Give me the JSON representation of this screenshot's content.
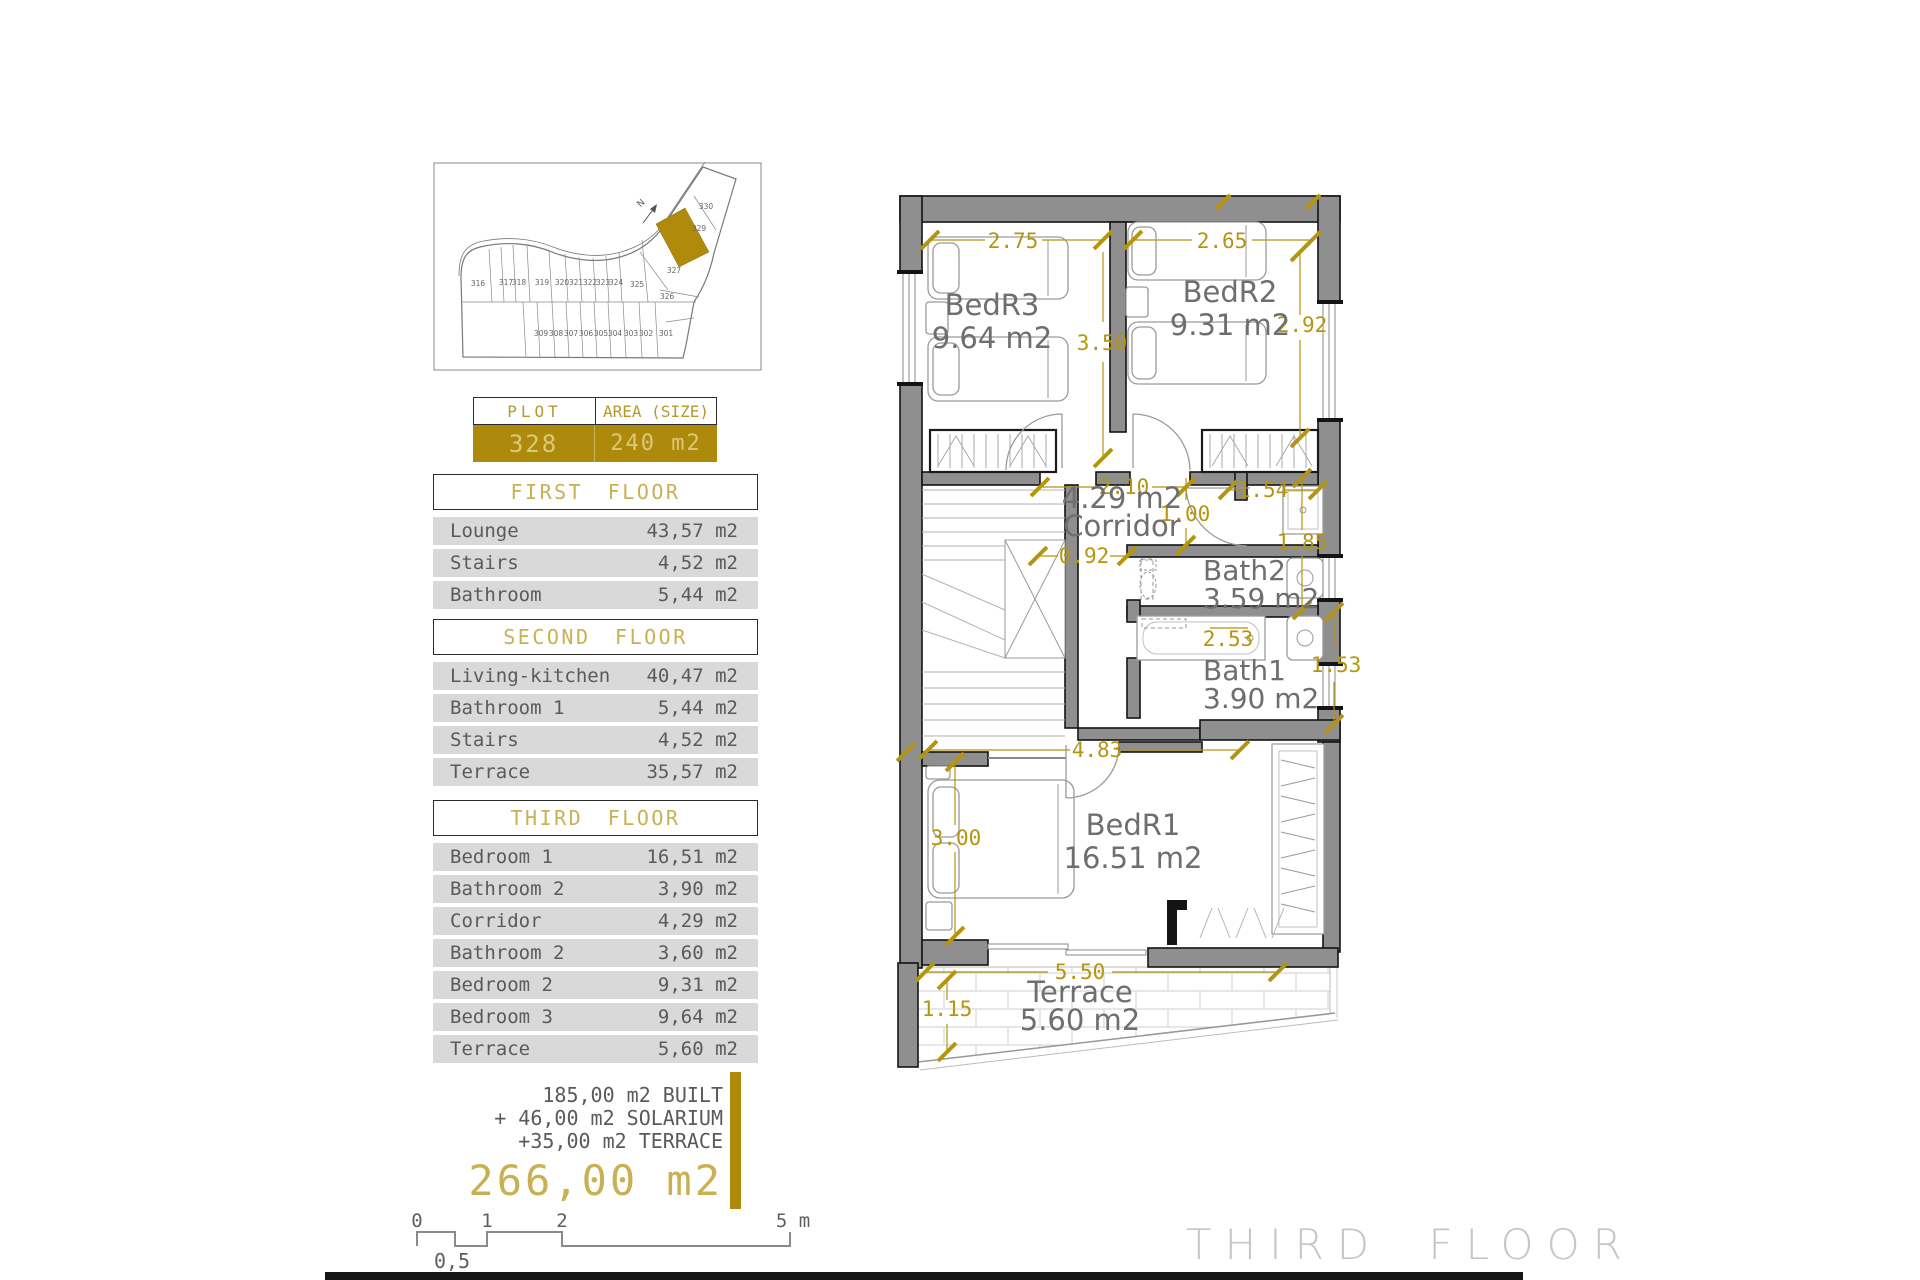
{
  "colors": {
    "gold": "#AD890C",
    "khaki": "#C9B052",
    "pale_gold": "#DCC878",
    "row_bg": "#D9D9D9",
    "text_gray": "#5A5A5A",
    "wall_gray": "#8F8F8F",
    "label_gray": "#6E6E6E",
    "dim_gold": "#B5950F",
    "caption_gray": "#C6C6C6"
  },
  "site_plan": {
    "north": "N",
    "top_row": [
      "316",
      "317",
      "318",
      "319",
      "320",
      "321",
      "322",
      "323",
      "324",
      "325"
    ],
    "bottom_row": [
      "309",
      "308",
      "307",
      "306",
      "305",
      "304",
      "303",
      "302",
      "301"
    ],
    "wing": [
      "330",
      "329",
      "327",
      "326"
    ],
    "highlighted_plot": "328"
  },
  "plot_table": {
    "col1_header": "PLOT",
    "col2_header": "AREA (SIZE)",
    "plot": "328",
    "area": "240 m2"
  },
  "floors": [
    {
      "title": "FIRST FLOOR",
      "rows": [
        {
          "label": "Lounge",
          "value": "43,57 m2"
        },
        {
          "label": "Stairs",
          "value": "4,52 m2"
        },
        {
          "label": "Bathroom",
          "value": "5,44 m2"
        }
      ]
    },
    {
      "title": "SECOND FLOOR",
      "rows": [
        {
          "label": "Living-kitchen",
          "value": "40,47 m2"
        },
        {
          "label": "Bathroom 1",
          "value": "5,44 m2"
        },
        {
          "label": "Stairs",
          "value": "4,52 m2"
        },
        {
          "label": "Terrace",
          "value": "35,57 m2"
        }
      ]
    },
    {
      "title": "THIRD FLOOR",
      "rows": [
        {
          "label": "Bedroom 1",
          "value": "16,51 m2"
        },
        {
          "label": "Bathroom 2",
          "value": "3,90 m2"
        },
        {
          "label": "Corridor",
          "value": "4,29 m2"
        },
        {
          "label": "Bathroom 2",
          "value": "3,60 m2"
        },
        {
          "label": "Bedroom 2",
          "value": "9,31 m2"
        },
        {
          "label": "Bedroom 3",
          "value": "9,64 m2"
        },
        {
          "label": "Terrace",
          "value": "5,60 m2"
        }
      ]
    }
  ],
  "summary": {
    "line1": "185,00 m2 BUILT",
    "line2": "+ 46,00 m2 SOLARIUM",
    "line3": "+35,00 m2 TERRACE",
    "total": "266,00 m2"
  },
  "scale_bar": {
    "ticks": [
      "0",
      "1",
      "2"
    ],
    "end": "5 m",
    "half": "0,5"
  },
  "floor_plan": {
    "caption": "THIRD FLOOR",
    "rooms": [
      {
        "name": "BedR3",
        "area": "9.64 m2"
      },
      {
        "name": "BedR2",
        "area": "9.31 m2"
      },
      {
        "name": "Corridor",
        "area": "4.29 m2"
      },
      {
        "name": "Bath2",
        "area": "3.59 m2"
      },
      {
        "name": "Bath1",
        "area": "3.90 m2"
      },
      {
        "name": "BedR1",
        "area": "16.51 m2"
      },
      {
        "name": "Terrace",
        "area": "5.60 m2"
      }
    ],
    "dims": [
      "2.75",
      "2.65",
      "3.50",
      "2.92",
      "2.10",
      "1.00",
      "1.54",
      "0.92",
      "1.85",
      "2.53",
      "1.53",
      "4.83",
      "3.00",
      "5.50",
      "1.15"
    ]
  }
}
